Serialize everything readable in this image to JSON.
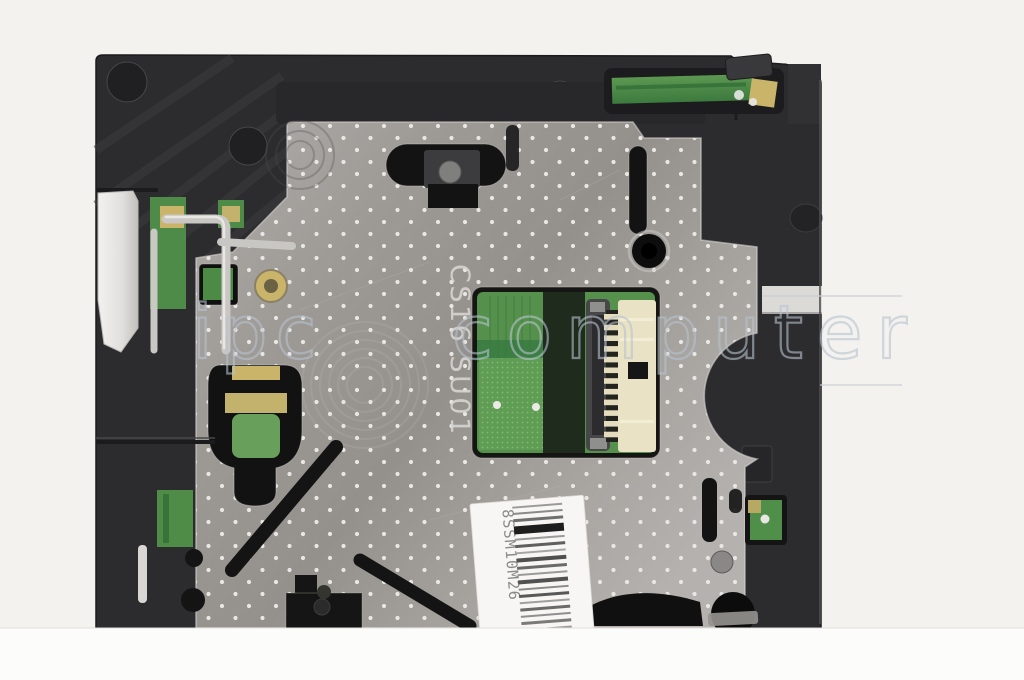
{
  "photo": {
    "plate_marking": "CS16 SU01",
    "label_code": "8SSM10M26",
    "watermark": {
      "word1": "ipc",
      "word2": "computer"
    },
    "colors": {
      "background": "#f4f2ef",
      "bottom_band": "#fcfcfa",
      "frame_black": "#2c2c2e",
      "metal_silver": "#a3a09d",
      "metal_dots": "#e9e7e4",
      "pcb_green": "#55914c",
      "pcb_green_dark": "#1f2b1d",
      "gold_contact": "#c9b46a",
      "connector_cream": "#eae2c4",
      "label_white": "#f7f6f4",
      "watermark_blue": "#b6c3cf"
    },
    "barcode": {
      "bars": [
        [
          2,
          "#9a9a9a"
        ],
        [
          2,
          "#8a8a8a"
        ],
        [
          3,
          "#6f6f6f"
        ],
        [
          8,
          "#1e1e1e"
        ],
        [
          2,
          "#9a9a9a"
        ],
        [
          3,
          "#5f5f5f"
        ],
        [
          2,
          "#a5a5a5"
        ],
        [
          4,
          "#4f4f4f"
        ],
        [
          3,
          "#6a6a6a"
        ],
        [
          2,
          "#9a9a9a"
        ],
        [
          4,
          "#525252"
        ],
        [
          2,
          "#8a8a8a"
        ],
        [
          3,
          "#585858"
        ],
        [
          2,
          "#9f9f9f"
        ],
        [
          3,
          "#6a6a6a"
        ],
        [
          2,
          "#8f8f8f"
        ],
        [
          3,
          "#7a7a7a"
        ],
        [
          2,
          "#9a9a9a"
        ]
      ]
    }
  }
}
